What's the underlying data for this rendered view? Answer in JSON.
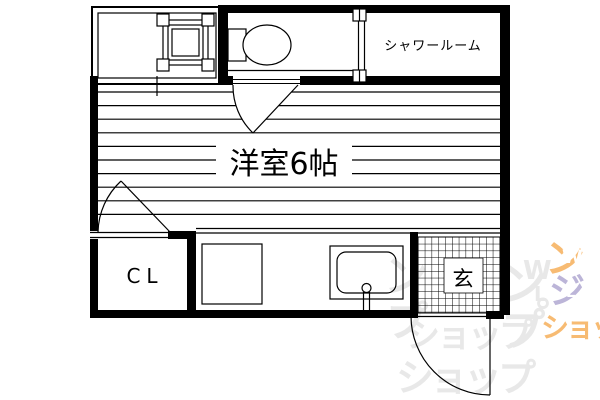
{
  "floorplan": {
    "labels": {
      "shower_room": "シャワールーム",
      "main_room": "洋室6帖",
      "closet": "CL",
      "entrance": "玄"
    },
    "colors": {
      "wall": "#000000",
      "line": "#000000",
      "paper": "#ffffff"
    }
  },
  "watermark": {
    "colors": {
      "gray": "#e8e8e8",
      "orange": "#f08300",
      "purple": "#8578b8",
      "white": "#ffffff"
    },
    "gray_glyphs": [
      "ン",
      "プ",
      "ン",
      "W",
      "L",
      "°",
      "プ",
      "ショップ",
      "ショップ"
    ],
    "colored_glyphs": [
      "ン",
      "W",
      "ジ",
      "L",
      "ショップ"
    ]
  }
}
